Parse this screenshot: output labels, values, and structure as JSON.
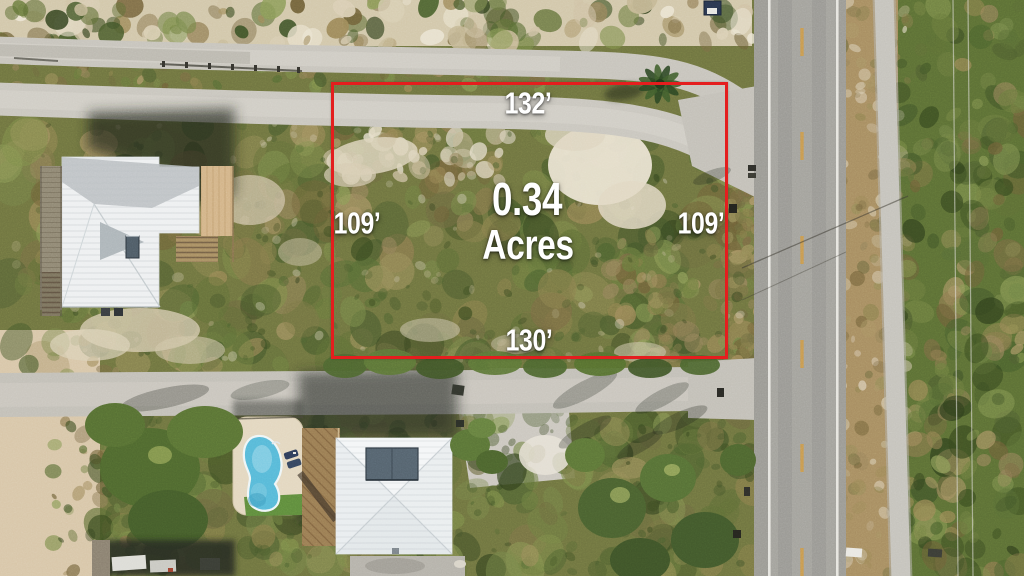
{
  "listing_overlay": {
    "area": {
      "value": "0.34",
      "unit": "Acres"
    },
    "dimensions": {
      "top": "132’",
      "left": "109’",
      "right": "109’",
      "bottom": "130’"
    },
    "colors": {
      "boundary": "#e41e1e",
      "label_text": "#ffffff"
    }
  }
}
